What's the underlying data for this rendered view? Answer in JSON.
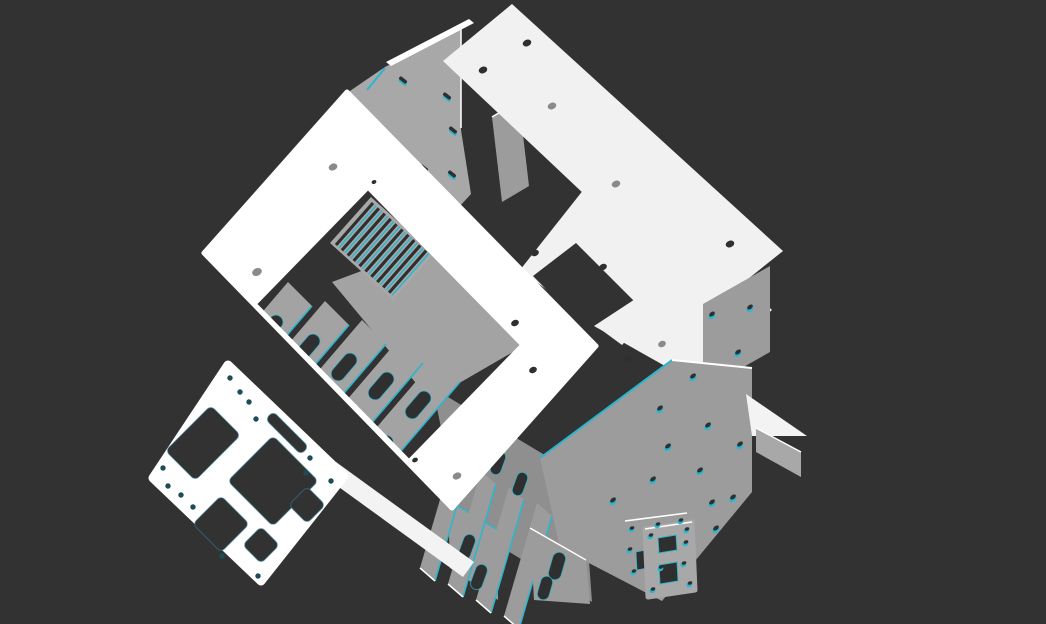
{
  "viewport": {
    "type": "3d-cad-viewport",
    "view": "isometric-exploded",
    "width": 1046,
    "height": 624,
    "background_color": "#323232",
    "edge_highlight_color": "#29b6cf"
  },
  "palette": {
    "background": "#323232",
    "face_white": "#ffffff",
    "face_offwhite": "#f1f1f1",
    "face_offwhite2": "#f3f3f3",
    "face_gray_light": "#a8a8a8",
    "face_gray": "#9c9c9c",
    "face_gray_mid": "#a3a3a3",
    "face_gray_dark": "#8f8f8f",
    "edge_cyan": "#29b6cf",
    "edge_white": "#ffffff",
    "hole_dark": "#2f2f2f",
    "hole_gray": "#8a8a8a",
    "hole_teal": "#1d4c58",
    "cut_edge_teal": "#2f7e93"
  },
  "model": {
    "name": "sheet-metal-enclosure-assembly",
    "parts": [
      {
        "id": "front-bezel-frame",
        "description": "White front frame with rectangular window cutout and mounting holes"
      },
      {
        "id": "top-cover-panel",
        "description": "Long white top cover strip with a row of mounting holes"
      },
      {
        "id": "rear-top-panel",
        "description": "Gray rear top panel with vent slot ticks and step notch"
      },
      {
        "id": "rear-panel-upper",
        "description": "White rear panel piece with L-shaped notch"
      },
      {
        "id": "rear-panel-lower",
        "description": "White lower rear panel piece"
      },
      {
        "id": "right-side-panel",
        "description": "Gray right side panel with grid of small mounting holes"
      },
      {
        "id": "right-corner-post",
        "description": "Gray corner post with two holes"
      },
      {
        "id": "right-flange-bracket",
        "description": "Small gray flange bracket protruding at right"
      },
      {
        "id": "vent-grille",
        "description": "Diagonal vent slats visible through the front window"
      },
      {
        "id": "slotted-brackets",
        "description": "Internal gray brackets with keyhole slots and cyan edges"
      },
      {
        "id": "base-panel",
        "description": "Gray base floor panel"
      },
      {
        "id": "io-mounting-plate",
        "description": "Flat white plate with rectangular cutouts and screw holes lying at lower left"
      },
      {
        "id": "mount-plate-back",
        "description": "Small gray square mounting plate with corner holes and slot"
      },
      {
        "id": "mount-plate-front",
        "description": "Small gray square mounting plate with two rectangular cutouts"
      }
    ]
  }
}
